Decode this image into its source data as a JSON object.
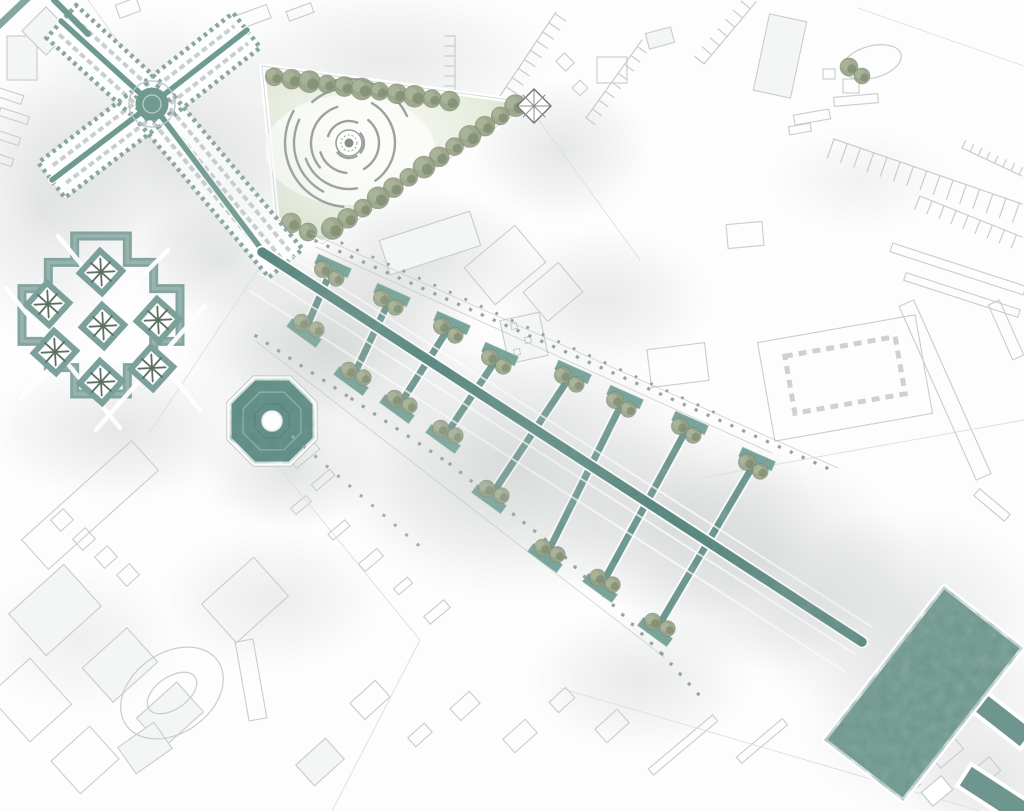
{
  "canvas": {
    "w": 1024,
    "h": 811
  },
  "palette": {
    "canal": "#6f9a92",
    "spine": "#618e86",
    "spine_dark": "#4c7d75",
    "plaza": "#6e968e",
    "octagon": "#6a958d",
    "cloister": "#7ca09a",
    "wall": "#8aa6a0",
    "dome": "#70998f",
    "tree_base": "#96a085",
    "tree_light": "#aab598",
    "tree_dark": "#7a8a6d",
    "tree_line": "#6d7b61",
    "lawn_edge": "#d5dcc6",
    "lawn_mid": "#e8ede0",
    "lawn_light": "#f8faf5",
    "dot": "#98a39d",
    "dot_gray": "#a6a9a6",
    "city_stroke": "#c8cdcb",
    "city_fill": "#f4f5f5",
    "parcel": "#dcdfdd",
    "fog": "#c2c6c5",
    "arc": "#9ba29c",
    "white": "#ffffff",
    "star": "#5f6f64"
  },
  "fog": [
    [
      160,
      140,
      180,
      130,
      0.45
    ],
    [
      45,
      210,
      100,
      130,
      0.4
    ],
    [
      120,
      430,
      130,
      70,
      0.4
    ],
    [
      330,
      350,
      150,
      100,
      0.55
    ],
    [
      520,
      470,
      190,
      130,
      0.5
    ],
    [
      680,
      520,
      140,
      100,
      0.5
    ],
    [
      420,
      260,
      120,
      70,
      0.45
    ],
    [
      600,
      300,
      110,
      70,
      0.35
    ],
    [
      760,
      560,
      150,
      110,
      0.45
    ],
    [
      900,
      620,
      150,
      110,
      0.4
    ],
    [
      940,
      720,
      140,
      100,
      0.35
    ],
    [
      270,
      600,
      110,
      70,
      0.3
    ],
    [
      390,
      60,
      160,
      70,
      0.35
    ],
    [
      560,
      150,
      90,
      70,
      0.4
    ],
    [
      220,
      260,
      90,
      60,
      0.45
    ],
    [
      1000,
      790,
      90,
      60,
      0.35
    ],
    [
      80,
      640,
      100,
      70,
      0.25
    ],
    [
      860,
      180,
      90,
      50,
      0.2
    ],
    [
      290,
      470,
      90,
      60,
      0.45
    ],
    [
      640,
      680,
      110,
      70,
      0.35
    ]
  ],
  "fog_top": [
    [
      500,
      460,
      170,
      110,
      0.22
    ],
    [
      330,
      330,
      120,
      80,
      0.2
    ],
    [
      820,
      600,
      130,
      90,
      0.18
    ],
    [
      240,
      180,
      110,
      80,
      0.15
    ]
  ],
  "city": {
    "rects": [
      [
        22,
        58,
        30,
        44,
        0,
        1
      ],
      [
        46,
        31,
        34,
        34,
        45,
        1
      ],
      [
        128,
        8,
        22,
        14,
        -20,
        0
      ],
      [
        10,
        96,
        26,
        9,
        18,
        0
      ],
      [
        14,
        116,
        30,
        8,
        18,
        0
      ],
      [
        8,
        138,
        24,
        8,
        18,
        0
      ],
      [
        4,
        160,
        18,
        8,
        18,
        0
      ],
      [
        250,
        18,
        40,
        14,
        -20,
        0
      ],
      [
        300,
        12,
        26,
        10,
        -20,
        0
      ],
      [
        565,
        62,
        14,
        12,
        45,
        0
      ],
      [
        580,
        88,
        11,
        11,
        45,
        0
      ],
      [
        612,
        70,
        30,
        26,
        0,
        0
      ],
      [
        660,
        38,
        26,
        16,
        -15,
        1
      ],
      [
        780,
        56,
        38,
        78,
        12,
        1
      ],
      [
        851,
        86,
        16,
        14,
        0,
        0
      ],
      [
        856,
        100,
        44,
        9,
        -5,
        0
      ],
      [
        829,
        74,
        12,
        10,
        0,
        0
      ],
      [
        812,
        117,
        36,
        10,
        -10,
        0
      ],
      [
        800,
        129,
        22,
        8,
        -10,
        0
      ],
      [
        958,
        269,
        140,
        9,
        18,
        0
      ],
      [
        962,
        295,
        120,
        8,
        18,
        0
      ],
      [
        945,
        390,
        190,
        16,
        66,
        0
      ],
      [
        1006,
        330,
        60,
        12,
        66,
        0
      ],
      [
        992,
        505,
        40,
        9,
        40,
        0
      ],
      [
        845,
        378,
        160,
        100,
        -10,
        0
      ],
      [
        745,
        235,
        36,
        24,
        -5,
        0
      ],
      [
        678,
        365,
        58,
        38,
        -7,
        0
      ],
      [
        524,
        338,
        40,
        44,
        -12,
        1
      ],
      [
        505,
        265,
        66,
        48,
        -40,
        0
      ],
      [
        553,
        292,
        46,
        38,
        -40,
        0
      ],
      [
        430,
        243,
        95,
        36,
        -18,
        1
      ],
      [
        90,
        505,
        148,
        40,
        -42,
        0
      ],
      [
        62,
        520,
        17,
        15,
        -42,
        0
      ],
      [
        84,
        539,
        17,
        15,
        -42,
        0
      ],
      [
        106,
        557,
        17,
        15,
        -42,
        0
      ],
      [
        128,
        575,
        17,
        15,
        -42,
        0
      ],
      [
        55,
        610,
        74,
        56,
        -42,
        1
      ],
      [
        120,
        665,
        60,
        46,
        -42,
        1
      ],
      [
        30,
        700,
        56,
        62,
        -42,
        0
      ],
      [
        170,
        715,
        54,
        40,
        -42,
        1
      ],
      [
        85,
        760,
        52,
        44,
        -42,
        0
      ],
      [
        245,
        600,
        70,
        52,
        -42,
        0
      ],
      [
        251,
        680,
        18,
        80,
        -10,
        0
      ],
      [
        320,
        762,
        40,
        28,
        -42,
        1
      ],
      [
        145,
        748,
        44,
        32,
        -35,
        1
      ],
      [
        370,
        700,
        34,
        22,
        -42,
        0
      ],
      [
        420,
        735,
        22,
        12,
        -42,
        0
      ],
      [
        465,
        706,
        26,
        16,
        -42,
        0
      ],
      [
        520,
        736,
        30,
        18,
        -42,
        0
      ],
      [
        562,
        700,
        22,
        14,
        -42,
        0
      ],
      [
        612,
        726,
        30,
        18,
        -42,
        0
      ],
      [
        683,
        745,
        84,
        8,
        -40,
        0
      ],
      [
        762,
        741,
        60,
        8,
        -40,
        0
      ],
      [
        945,
        750,
        30,
        22,
        -40,
        0
      ],
      [
        985,
        772,
        26,
        18,
        -40,
        0
      ],
      [
        906,
        786,
        24,
        16,
        -40,
        0
      ],
      [
        305,
        455,
        30,
        10,
        -40,
        0
      ],
      [
        323,
        480,
        24,
        8,
        -40,
        0
      ],
      [
        301,
        505,
        20,
        8,
        -40,
        0
      ],
      [
        339,
        530,
        22,
        8,
        -40,
        0
      ],
      [
        371,
        560,
        24,
        10,
        -40,
        0
      ],
      [
        403,
        586,
        18,
        8,
        -40,
        0
      ],
      [
        437,
        612,
        26,
        10,
        -40,
        0
      ]
    ],
    "combs": [
      [
        [
          500,
          96
        ],
        [
          556,
          12
        ],
        13,
        11,
        1
      ],
      [
        [
          586,
          118
        ],
        [
          642,
          40
        ],
        11,
        11,
        1
      ],
      [
        [
          704,
          64
        ],
        [
          756,
          2
        ],
        12,
        12,
        -1
      ],
      [
        [
          834,
          139
        ],
        [
          1022,
          204
        ],
        20,
        14,
        1
      ],
      [
        [
          920,
          196
        ],
        [
          1022,
          237
        ],
        14,
        13,
        1
      ],
      [
        [
          962,
          148
        ],
        [
          1022,
          176
        ],
        8,
        9,
        -1
      ],
      [
        [
          455,
          96
        ],
        [
          455,
          36
        ],
        10,
        10,
        -1
      ]
    ],
    "ellipses": [
      [
        872,
        62,
        30,
        16,
        -15
      ],
      [
        172,
        693,
        56,
        40,
        -35
      ],
      [
        172,
        693,
        28,
        16,
        -35
      ]
    ],
    "dashed_rect": [
      845,
      375,
      112,
      58,
      -10
    ],
    "house_squares": [
      [
        514,
        326,
        6
      ],
      [
        528,
        340,
        6
      ],
      [
        517,
        352,
        6
      ]
    ]
  },
  "parcels": [
    [
      [
        88,
        0
      ],
      [
        268,
        252
      ]
    ],
    [
      [
        268,
        255
      ],
      [
        150,
        432
      ]
    ],
    [
      [
        250,
        432
      ],
      [
        420,
        640
      ]
    ],
    [
      [
        420,
        640
      ],
      [
        332,
        811
      ]
    ],
    [
      [
        700,
        478
      ],
      [
        1024,
        420
      ]
    ],
    [
      [
        560,
        688
      ],
      [
        980,
        811
      ]
    ],
    [
      [
        858,
        8
      ],
      [
        1024,
        66
      ]
    ],
    [
      [
        535,
        115
      ],
      [
        640,
        260
      ]
    ]
  ],
  "park": {
    "polygon": [
      [
        262,
        66
      ],
      [
        532,
        103
      ],
      [
        322,
        244
      ],
      [
        277,
        219
      ]
    ],
    "center": [
      349,
      143
    ],
    "arcs": [
      [
        64,
        95,
        210
      ],
      [
        64,
        250,
        335
      ],
      [
        55,
        118,
        205
      ],
      [
        55,
        228,
        302
      ],
      [
        46,
        300,
        415
      ],
      [
        46,
        80,
        160
      ],
      [
        38,
        140,
        252
      ],
      [
        30,
        310,
        420
      ],
      [
        30,
        95,
        162
      ],
      [
        22,
        198,
        292
      ],
      [
        15,
        320,
        400
      ],
      [
        15,
        60,
        140
      ]
    ],
    "trees": [
      [
        274.2,
        76.8
      ],
      [
        291.7,
        79.2
      ],
      [
        309.3,
        81.6
      ],
      [
        326.9,
        84.1
      ],
      [
        344.4,
        86.5
      ],
      [
        361.9,
        88.9
      ],
      [
        379.5,
        91.3
      ],
      [
        397,
        93.7
      ],
      [
        414.5,
        96.2
      ],
      [
        432,
        98.6
      ],
      [
        449.6,
        101
      ],
      [
        515.6,
        105.6
      ],
      [
        500.3,
        115.9
      ],
      [
        485,
        126.1
      ],
      [
        469.8,
        136.4
      ],
      [
        454.5,
        146.6
      ],
      [
        439.2,
        156.8
      ],
      [
        424,
        167.1
      ],
      [
        408.7,
        177.3
      ],
      [
        393.4,
        187.6
      ],
      [
        378.1,
        197.8
      ],
      [
        362.9,
        208.1
      ],
      [
        347.6,
        218.3
      ],
      [
        332.3,
        228.5
      ],
      [
        308,
        232
      ],
      [
        291,
        223
      ]
    ],
    "pavilion": [
      534,
      106,
      24,
      45
    ]
  },
  "cloister": {
    "center": [
      101,
      315
    ],
    "radius": 79,
    "steps": 3,
    "planters": [
      [
        101,
        272
      ],
      [
        48,
        304
      ],
      [
        103,
        326
      ],
      [
        158,
        320
      ],
      [
        55,
        352
      ],
      [
        152,
        368
      ],
      [
        101,
        382
      ]
    ],
    "planter_size": 30,
    "planter_rot": 42,
    "roads": [
      [
        [
          58,
          236
        ],
        [
          200,
          410
        ]
      ],
      [
        [
          6,
          288
        ],
        [
          120,
          428
        ]
      ],
      [
        [
          168,
          250
        ],
        [
          20,
          398
        ]
      ],
      [
        [
          205,
          306
        ],
        [
          96,
          430
        ]
      ]
    ]
  },
  "octagon": {
    "cx": 272,
    "cy": 421,
    "r": 46,
    "hole_r": 10
  },
  "cross_building": {
    "center": [
      152,
      104
    ],
    "arms": [
      [
        103.9,
        60.3,
        115,
        44,
        222.3
      ],
      [
        202.5,
        64.7,
        112,
        44,
        -37.9
      ],
      [
        98.6,
        144.5,
        118,
        44,
        142.8
      ],
      [
        221.4,
        186.7,
        200,
        44,
        50
      ]
    ],
    "tips": [
      [
        61,
        21
      ],
      [
        247,
        30
      ],
      [
        52,
        180
      ],
      [
        268,
        258
      ]
    ],
    "dome_r": 16.5,
    "ring_r": 23,
    "entry_canal": [
      [
        54,
        0
      ],
      [
        88,
        34
      ]
    ],
    "corner_band": [
      [
        -6,
        30
      ],
      [
        34,
        -8
      ]
    ]
  },
  "promenade": {
    "spine": [
      [
        262,
        252
      ],
      [
        862,
        642
      ]
    ],
    "stripes": [
      [
        [
          278,
          247
        ],
        [
          872,
          627
        ]
      ],
      [
        [
          261,
          274
        ],
        [
          855,
          654
        ]
      ],
      [
        [
          250,
          291
        ],
        [
          844,
          671
        ]
      ]
    ],
    "guides": [
      [
        [
          316,
          247
        ],
        [
          772,
          453
        ]
      ],
      [
        [
          257,
          342
        ],
        [
          664,
          657
        ]
      ],
      [
        [
          311,
          233
        ],
        [
          838,
          468
        ]
      ]
    ],
    "dot_rows": [
      {
        "pts": [
          [
            316,
            241
          ],
          [
            836,
            472
          ]
        ],
        "gap": 13,
        "s": 3.2,
        "c": "dot"
      },
      {
        "pts": [
          [
            311,
            229
          ],
          [
            720,
            415
          ]
        ],
        "gap": 17,
        "s": 2.8,
        "c": "dot"
      },
      {
        "pts": [
          [
            256,
            336
          ],
          [
            352,
            399
          ],
          [
            450,
            464
          ],
          [
            556,
            548
          ],
          [
            662,
            654
          ],
          [
            700,
            696
          ]
        ],
        "gap": 13.5,
        "s": 3.2,
        "c": "dot"
      },
      {
        "pts": [
          [
            293,
            437
          ],
          [
            424,
            550
          ]
        ],
        "gap": 15,
        "s": 3.0,
        "c": "dot_gray"
      }
    ],
    "upper_platforms": [
      [
        333,
        266
      ],
      [
        392,
        295
      ],
      [
        452,
        323
      ],
      [
        500,
        354
      ],
      [
        573,
        372
      ],
      [
        625,
        397
      ],
      [
        690,
        423
      ],
      [
        757,
        459
      ]
    ],
    "lower_platforms": [
      [
        304,
        333
      ],
      [
        351,
        381
      ],
      [
        397,
        409
      ],
      [
        443,
        439
      ],
      [
        489,
        499
      ],
      [
        545,
        558
      ],
      [
        600,
        588
      ],
      [
        655,
        632
      ]
    ],
    "upper_rot": 24,
    "lower_rot": 36,
    "fingers": [
      [
        333,
        266,
        304,
        333
      ],
      [
        392,
        295,
        351,
        381
      ],
      [
        452,
        323,
        397,
        409
      ],
      [
        500,
        354,
        443,
        439
      ],
      [
        573,
        372,
        489,
        499
      ],
      [
        625,
        397,
        545,
        558
      ],
      [
        690,
        423,
        600,
        588
      ],
      [
        757,
        459,
        655,
        632
      ]
    ]
  },
  "plaza": {
    "polygon": [
      [
        944,
        586
      ],
      [
        1023,
        648
      ],
      [
        903,
        801
      ],
      [
        824,
        740
      ]
    ],
    "arm": [
      1004,
      721,
      60,
      24,
      38
    ],
    "exit_path": [
      1001,
      799,
      88,
      26,
      33
    ],
    "small_building": [
      937,
      791,
      26,
      18,
      -40
    ]
  },
  "extra_trees": [
    [
      849,
      67,
      9
    ],
    [
      862,
      76,
      8
    ]
  ]
}
